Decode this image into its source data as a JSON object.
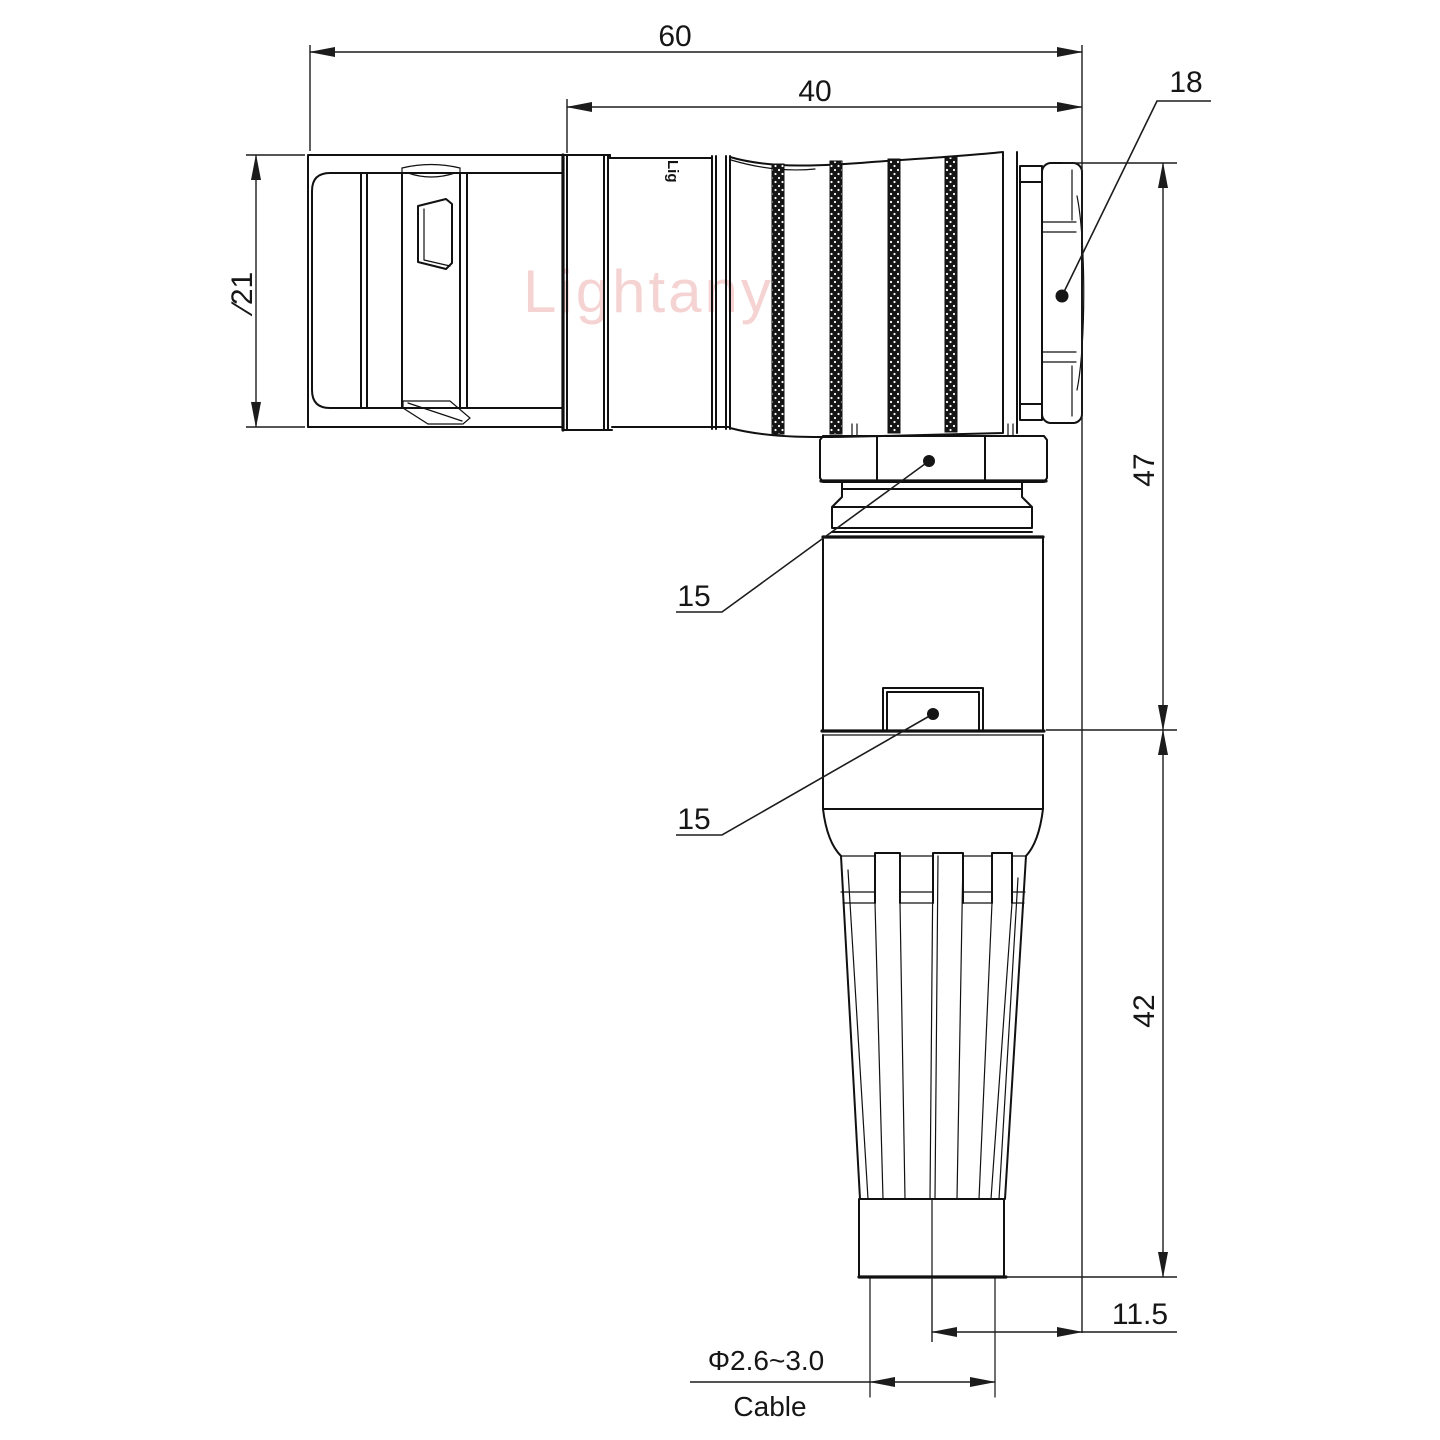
{
  "drawing": {
    "type": "technical-drawing",
    "view": "right-angle connector, side elevation",
    "units": "mm"
  },
  "dims": {
    "overall_length": "60",
    "boot_length": "40",
    "nut_size": "18",
    "front_diameter": "∕21",
    "coupling_nut_width": "15",
    "body_width": "15",
    "height_upper": "47",
    "height_lower": "42",
    "cable_offset": "11.5",
    "cable_diameter": "Φ2.6~3.0",
    "cable_caption": "Cable"
  },
  "watermark": {
    "text": "Lightany",
    "color": "#eeb0b0"
  },
  "marking": {
    "text": "Lig"
  },
  "colors": {
    "line": "#111111",
    "dimension": "#1c1c1c",
    "background": "#ffffff"
  }
}
